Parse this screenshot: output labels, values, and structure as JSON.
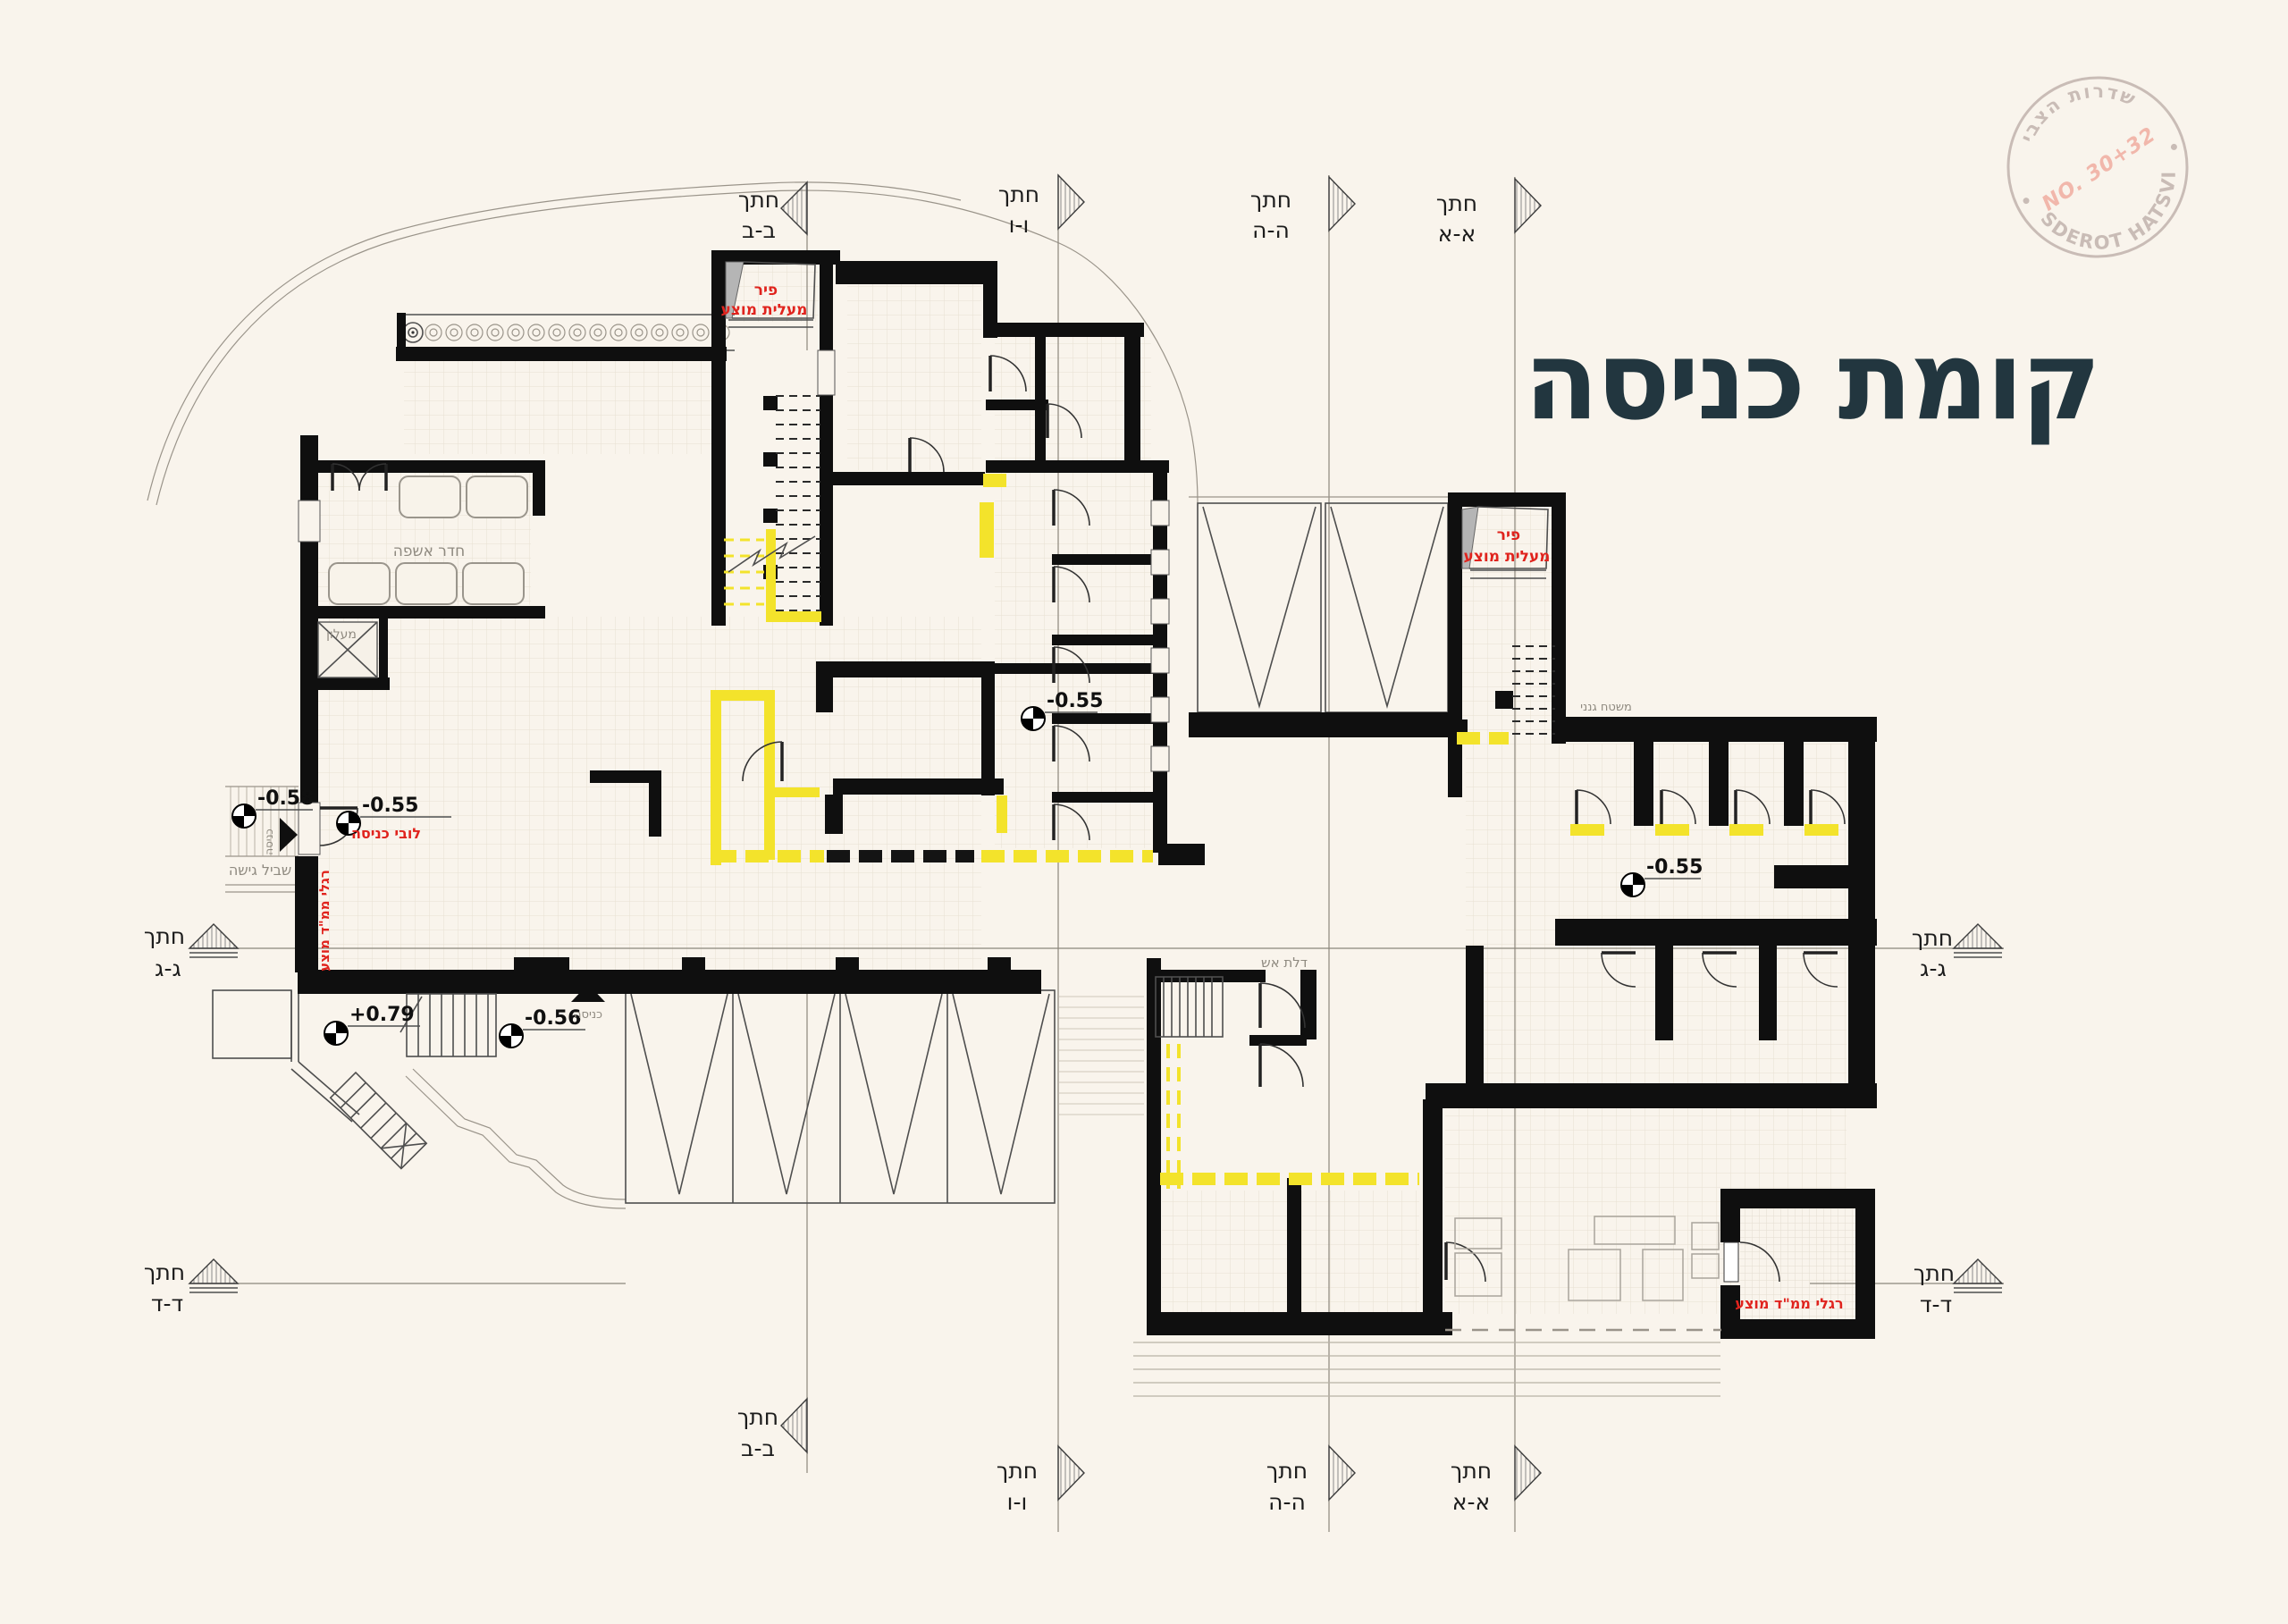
{
  "title": "קומת כניסה",
  "stamp": {
    "arc_top": "שדרות הצבי",
    "arc_bottom": "SDEROT HATSVI",
    "number": "NO. 30+32"
  },
  "markers": {
    "word": "חתך",
    "codes": {
      "aa": "א-א",
      "bb": "ב-ב",
      "gg": "ג-ג",
      "dd": "ד-ד",
      "hh": "ה-ה",
      "vv": "ו-ו"
    }
  },
  "levels": {
    "entry_path": "-0.58",
    "lobby": "-0.55",
    "upper_entry": "+0.79",
    "south_entry": "-0.56",
    "hall": "-0.55",
    "east_corridor": "-0.55"
  },
  "labels": {
    "shaft": {
      "line1": "פיר",
      "line2": "מעלית מוצע"
    },
    "lobby": "לובי כניסה",
    "mamad_legs": "רגלי ממ\"ד מוצע",
    "trash_room": "חדר אשפה",
    "lift": "מעלון",
    "access_path": "שביל גישה",
    "entrance": "כניסה",
    "garden": "משטח גנני",
    "fire_door": "דלת אש"
  }
}
